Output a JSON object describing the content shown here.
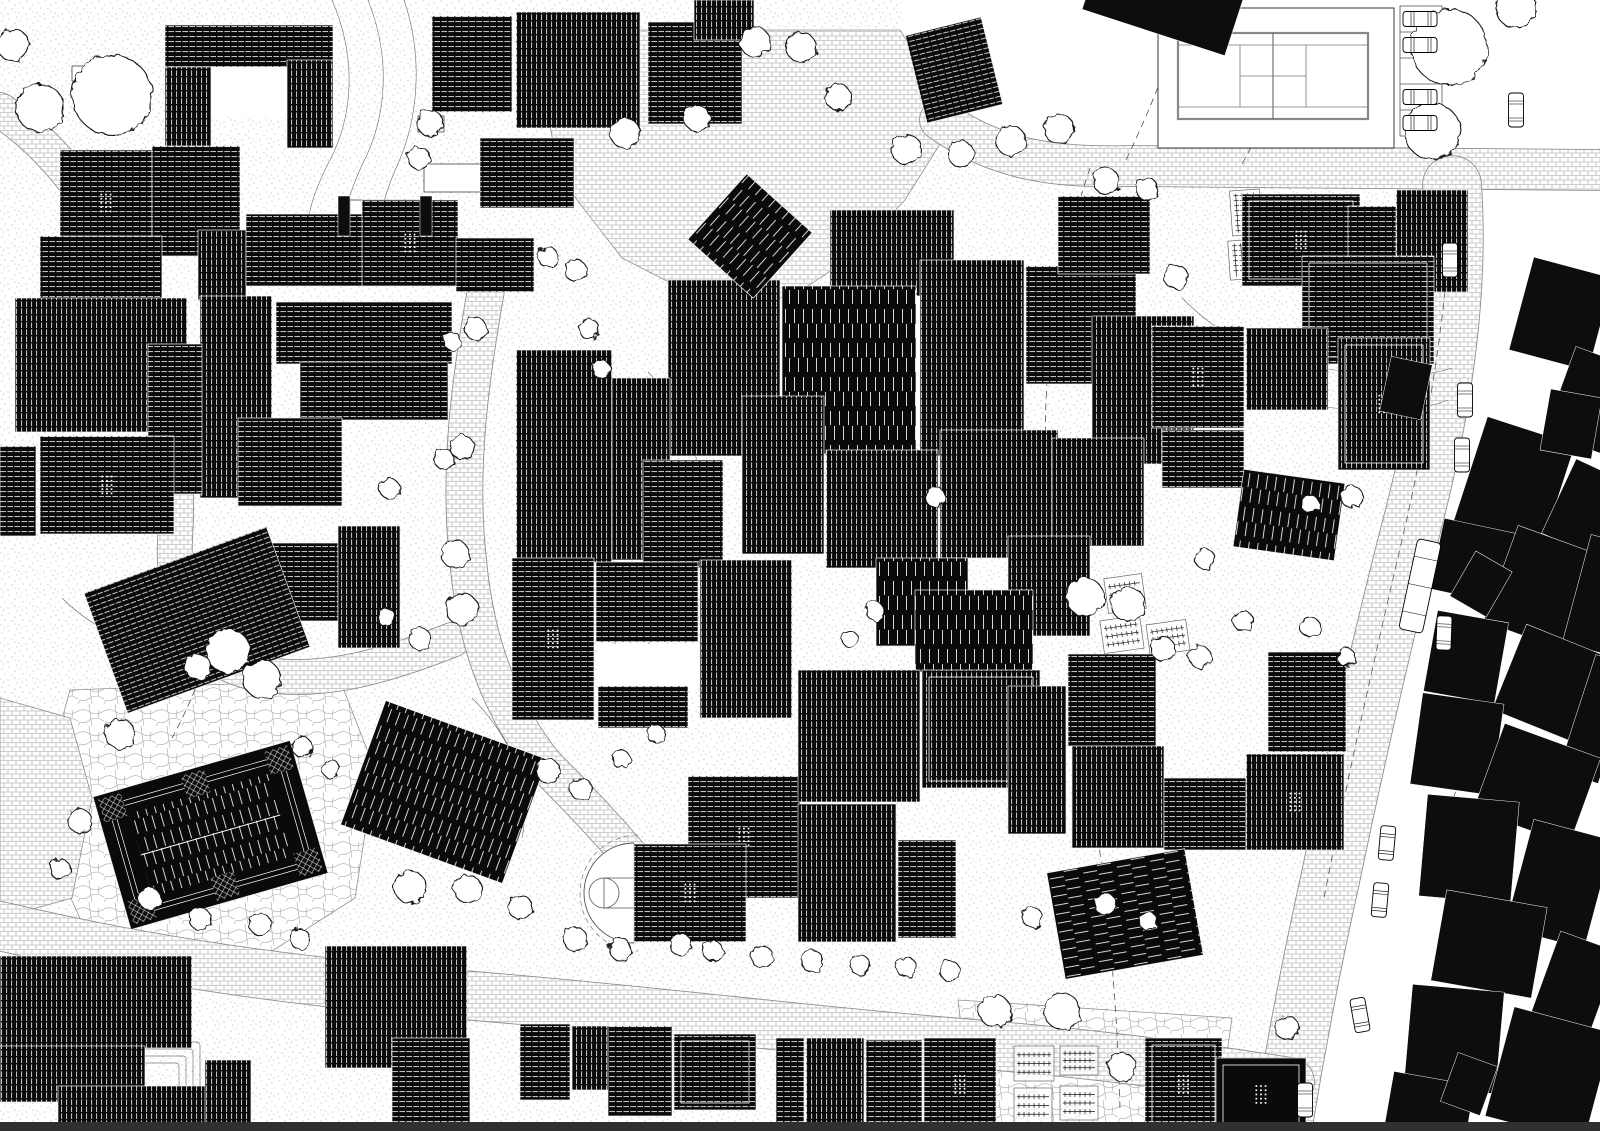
{
  "canvas": {
    "width": 1600,
    "height": 1131,
    "background": "#ffffff"
  },
  "palette": {
    "building_fill": "#0a0a0a",
    "context_fill": "#0d0d0d",
    "hatch_line": "#ececec",
    "road_edge": "#8f8f8f",
    "court_line": "#888888",
    "contour_line": "#6a6a6a",
    "dash_line": "#555555",
    "tree_stroke": "#141414",
    "bottom_strip": "#303030"
  },
  "legend": {
    "h": "horizontal-ridge-hatch-roof",
    "v": "vertical-ridge-hatch-roof",
    "vd": "standing-seam-vertical-roof",
    "hd": "standing-seam-horizontal-roof",
    "s": "solid-black-roof",
    "flag_d": "rooflight-dot-grid",
    "flag_i": "white-inset-parapet-line"
  },
  "zones_white": [
    "1125,0 1600,0 1600,148 1125,148",
    "1468,186 1600,186 1600,1131 1284,1131 1318,952 1362,762 1412,562 1452,362",
    "902,0 1128,0 1128,148 995,148 902,58"
  ],
  "plazas": [
    {
      "texture": "cobble",
      "points": "560,30 900,30 955,120 905,200 850,258 790,298 700,298 622,258 560,178 545,100"
    },
    {
      "texture": "flagstone",
      "points": "70,690 340,680 375,770 355,898 255,962 95,952 35,818"
    },
    {
      "texture": "cobble",
      "points": "0,698 70,718 92,798 72,898 0,918"
    },
    {
      "texture": "flagstone",
      "points": "958,1000 1232,1018 1216,1131 974,1131"
    }
  ],
  "roads": [
    {
      "d": "M940,120 C1000,162 1060,168 1130,166 L1600,170",
      "w": 40
    },
    {
      "d": "M1452,185 C1460,300 1440,420 1408,540 C1380,650 1355,760 1330,880 C1310,970 1295,1050 1282,1131",
      "w": 58
    },
    {
      "d": "M0,926 C150,962 300,982 450,994 C650,1010 800,1030 950,1042 C1050,1050 1150,1060 1290,1082",
      "w": 48
    },
    {
      "d": "M0,110 C60,150 110,220 140,300 C170,380 180,460 175,540 C172,620 195,662 260,674 C330,686 400,660 452,640",
      "w": 34
    },
    {
      "d": "M486,290 C470,380 458,470 468,560 C476,650 505,715 545,765 C580,800 608,830 630,856",
      "w": 36
    }
  ],
  "contour_lines": [
    "M332,0 C358,60 352,118 330,160 C310,198 302,228 312,258",
    "M368,0 C392,60 386,120 362,165 C344,205 338,232 348,262",
    "M404,0 C424,58 418,122 396,168 C380,206 374,236 382,262",
    "M622,382 C660,420 680,468 670,518 C660,568 640,608 612,648",
    "M648,372 C688,414 708,468 698,524 C690,570 672,612 644,650",
    "M942,438 C982,468 1002,498 992,538",
    "M1182,298 C1222,338 1262,358 1322,368 C1382,378 1422,378 1452,368",
    "M1174,336 C1216,376 1258,396 1318,406 C1378,414 1418,412 1448,400",
    "M62,598 C102,638 142,648 202,642",
    "M472,698 C512,738 532,788 522,838",
    "M22,1058 C62,1078 102,1088 162,1088"
  ],
  "dashed_lines": [
    "M1185,8 C1170,60 1150,110 1126,160",
    "M1300,12 C1290,66 1268,118 1242,164",
    "M1090,168 C1060,258 1042,358 1046,458",
    "M1452,195 C1448,300 1430,420 1402,540 C1374,660 1347,780 1324,898",
    "M1098,838 C1110,928 1118,1018 1120,1110",
    "M1502,618 C1482,698 1456,788 1432,878",
    "M232,538 C225,608 205,678 172,738"
  ],
  "terraces": [
    [
      940,
      445,
      90,
      55,
      4
    ],
    [
      60,
      1042,
      140,
      70,
      4
    ]
  ],
  "buildings": [
    [
      165,
      25,
      168,
      42,
      0,
      "h",
      ""
    ],
    [
      165,
      67,
      46,
      82,
      0,
      "v",
      ""
    ],
    [
      287,
      60,
      46,
      88,
      0,
      "v",
      ""
    ],
    [
      60,
      150,
      92,
      106,
      0,
      "h",
      "d"
    ],
    [
      152,
      146,
      88,
      110,
      0,
      "h",
      ""
    ],
    [
      40,
      236,
      122,
      66,
      0,
      "h",
      ""
    ],
    [
      198,
      230,
      48,
      70,
      0,
      "v",
      ""
    ],
    [
      246,
      214,
      118,
      72,
      0,
      "h",
      ""
    ],
    [
      362,
      200,
      96,
      86,
      0,
      "h",
      "d"
    ],
    [
      456,
      238,
      78,
      54,
      0,
      "h",
      ""
    ],
    [
      432,
      16,
      80,
      96,
      0,
      "h",
      ""
    ],
    [
      516,
      12,
      124,
      116,
      0,
      "v",
      ""
    ],
    [
      648,
      22,
      94,
      102,
      0,
      "h",
      ""
    ],
    [
      694,
      0,
      60,
      40,
      0,
      "v",
      ""
    ],
    [
      480,
      138,
      94,
      70,
      0,
      "h",
      ""
    ],
    [
      915,
      25,
      78,
      90,
      -14,
      "h",
      ""
    ],
    [
      15,
      298,
      172,
      134,
      0,
      "v",
      ""
    ],
    [
      200,
      296,
      72,
      202,
      0,
      "v",
      ""
    ],
    [
      276,
      302,
      176,
      62,
      0,
      "h",
      ""
    ],
    [
      300,
      362,
      148,
      58,
      0,
      "h",
      ""
    ],
    [
      148,
      344,
      54,
      150,
      0,
      "h",
      ""
    ],
    [
      40,
      436,
      134,
      98,
      0,
      "h",
      "d"
    ],
    [
      238,
      418,
      104,
      88,
      0,
      "h",
      ""
    ],
    [
      240,
      543,
      98,
      78,
      0,
      "h",
      ""
    ],
    [
      338,
      526,
      62,
      122,
      0,
      "v",
      ""
    ],
    [
      100,
      556,
      194,
      128,
      -20,
      "h",
      ""
    ],
    [
      0,
      446,
      36,
      90,
      0,
      "h",
      ""
    ],
    [
      830,
      210,
      124,
      86,
      0,
      "v",
      ""
    ],
    [
      668,
      280,
      112,
      176,
      0,
      "v",
      ""
    ],
    [
      782,
      286,
      134,
      168,
      0,
      "vd",
      ""
    ],
    [
      920,
      260,
      104,
      196,
      0,
      "v",
      ""
    ],
    [
      1026,
      266,
      110,
      118,
      0,
      "h",
      ""
    ],
    [
      1058,
      196,
      92,
      78,
      0,
      "h",
      ""
    ],
    [
      1092,
      316,
      102,
      148,
      0,
      "v",
      ""
    ],
    [
      742,
      396,
      82,
      158,
      0,
      "v",
      ""
    ],
    [
      826,
      450,
      112,
      118,
      0,
      "v",
      ""
    ],
    [
      940,
      430,
      118,
      128,
      0,
      "v",
      ""
    ],
    [
      1052,
      438,
      92,
      108,
      0,
      "v",
      ""
    ],
    [
      876,
      558,
      92,
      88,
      0,
      "vd",
      ""
    ],
    [
      1008,
      536,
      82,
      100,
      0,
      "v",
      ""
    ],
    [
      915,
      590,
      118,
      82,
      0,
      "vd",
      ""
    ],
    [
      516,
      350,
      96,
      212,
      0,
      "v",
      ""
    ],
    [
      612,
      378,
      58,
      182,
      0,
      "v",
      ""
    ],
    [
      643,
      460,
      80,
      108,
      0,
      "h",
      ""
    ],
    [
      706,
      192,
      88,
      88,
      42,
      "vd",
      ""
    ],
    [
      512,
      558,
      82,
      162,
      0,
      "h",
      "d"
    ],
    [
      596,
      562,
      102,
      80,
      0,
      "h",
      ""
    ],
    [
      700,
      560,
      92,
      158,
      0,
      "v",
      ""
    ],
    [
      598,
      686,
      90,
      42,
      0,
      "h",
      ""
    ],
    [
      688,
      776,
      112,
      122,
      0,
      "h",
      "d"
    ],
    [
      798,
      670,
      122,
      132,
      0,
      "v",
      ""
    ],
    [
      922,
      670,
      118,
      118,
      0,
      "v",
      "i"
    ],
    [
      1008,
      686,
      58,
      148,
      0,
      "v",
      ""
    ],
    [
      798,
      804,
      98,
      138,
      0,
      "v",
      ""
    ],
    [
      898,
      840,
      58,
      98,
      0,
      "h",
      ""
    ],
    [
      634,
      844,
      112,
      98,
      0,
      "h",
      "d"
    ],
    [
      1068,
      654,
      88,
      92,
      0,
      "h",
      ""
    ],
    [
      1072,
      746,
      92,
      102,
      0,
      "v",
      ""
    ],
    [
      1164,
      778,
      82,
      72,
      0,
      "h",
      ""
    ],
    [
      1246,
      754,
      98,
      96,
      0,
      "v",
      "d"
    ],
    [
      1268,
      652,
      78,
      100,
      0,
      "h",
      ""
    ],
    [
      1055,
      860,
      140,
      108,
      -10,
      "hd",
      ""
    ],
    [
      1242,
      194,
      118,
      92,
      0,
      "h",
      "di"
    ],
    [
      1348,
      206,
      78,
      82,
      0,
      "h",
      ""
    ],
    [
      1396,
      190,
      72,
      102,
      0,
      "v",
      ""
    ],
    [
      1302,
      256,
      132,
      108,
      0,
      "h",
      "i"
    ],
    [
      1152,
      326,
      92,
      102,
      0,
      "h",
      "d"
    ],
    [
      1246,
      328,
      82,
      82,
      0,
      "v",
      ""
    ],
    [
      1338,
      338,
      92,
      132,
      0,
      "v",
      "di"
    ],
    [
      1162,
      430,
      82,
      58,
      0,
      "h",
      ""
    ],
    [
      1238,
      476,
      102,
      78,
      8,
      "vd",
      ""
    ],
    [
      358,
      726,
      172,
      132,
      20,
      "vd",
      ""
    ],
    [
      0,
      956,
      192,
      92,
      0,
      "v",
      ""
    ],
    [
      0,
      1046,
      145,
      56,
      0,
      "v",
      ""
    ],
    [
      58,
      1086,
      190,
      45,
      0,
      "v",
      ""
    ],
    [
      205,
      1060,
      46,
      71,
      0,
      "v",
      ""
    ],
    [
      325,
      946,
      142,
      122,
      0,
      "v",
      ""
    ],
    [
      392,
      1038,
      78,
      93,
      0,
      "h",
      ""
    ],
    [
      520,
      1024,
      50,
      76,
      0,
      "h",
      ""
    ],
    [
      572,
      1026,
      40,
      64,
      0,
      "v",
      ""
    ],
    [
      608,
      1026,
      64,
      90,
      0,
      "h",
      ""
    ],
    [
      674,
      1034,
      82,
      76,
      0,
      "h",
      "i"
    ],
    [
      776,
      1038,
      28,
      93,
      0,
      "h",
      ""
    ],
    [
      806,
      1038,
      58,
      93,
      0,
      "v",
      ""
    ],
    [
      866,
      1040,
      56,
      91,
      0,
      "h",
      ""
    ],
    [
      924,
      1038,
      72,
      93,
      0,
      "h",
      "d"
    ],
    [
      1145,
      1038,
      77,
      93,
      0,
      "h",
      "di"
    ],
    [
      1216,
      1058,
      90,
      73,
      0,
      "s",
      "di"
    ]
  ],
  "special_building": {
    "x": 108,
    "y": 766,
    "w": 205,
    "h": 138,
    "rot": -16
  },
  "context_buildings": [
    [
      1088,
      -28,
      150,
      62,
      18
    ],
    [
      338,
      196,
      12,
      40,
      0
    ],
    [
      420,
      196,
      12,
      40,
      0
    ],
    [
      1520,
      266,
      82,
      96,
      15
    ],
    [
      1558,
      356,
      72,
      92,
      20
    ],
    [
      1468,
      428,
      92,
      112,
      18
    ],
    [
      1556,
      468,
      62,
      82,
      25
    ],
    [
      1436,
      526,
      82,
      72,
      12
    ],
    [
      1498,
      538,
      92,
      102,
      20
    ],
    [
      1576,
      538,
      42,
      112,
      15
    ],
    [
      1430,
      616,
      72,
      82,
      10
    ],
    [
      1506,
      638,
      92,
      92,
      22
    ],
    [
      1576,
      658,
      42,
      122,
      18
    ],
    [
      1416,
      698,
      82,
      92,
      8
    ],
    [
      1486,
      738,
      102,
      92,
      20
    ],
    [
      1423,
      798,
      92,
      102,
      5
    ],
    [
      1518,
      828,
      82,
      112,
      15
    ],
    [
      1438,
      898,
      102,
      92,
      10
    ],
    [
      1538,
      938,
      62,
      122,
      20
    ],
    [
      1408,
      988,
      92,
      102,
      5
    ],
    [
      1498,
      1018,
      102,
      113,
      15
    ],
    [
      1388,
      1078,
      82,
      62,
      10
    ],
    [
      1545,
      393,
      52,
      62,
      10
    ],
    [
      1460,
      558,
      42,
      52,
      30
    ],
    [
      1448,
      1058,
      42,
      52,
      20
    ],
    [
      1385,
      360,
      42,
      56,
      12
    ]
  ],
  "white_rects": [
    [
      200,
      57,
      90,
      60
    ],
    [
      888,
      296,
      34,
      136
    ],
    [
      1322,
      282,
      76,
      56
    ],
    [
      598,
      644,
      102,
      44
    ]
  ],
  "misc_platforms": [
    [
      72,
      66,
      26,
      15
    ],
    [
      418,
      116,
      26,
      16
    ],
    [
      424,
      164,
      58,
      28
    ],
    [
      350,
      200,
      72,
      32
    ],
    [
      700,
      420,
      16,
      24
    ]
  ],
  "tennis_court": {
    "outer": [
      1158,
      8,
      236,
      140
    ],
    "court": [
      1178,
      33,
      190,
      86
    ]
  },
  "parking": {
    "lot": [
      1400,
      6,
      42,
      130
    ],
    "stalls": 5
  },
  "basketball_court": {
    "cx": 634,
    "cy": 893,
    "r": 50,
    "key_half": 15,
    "circle_r": 15,
    "dash_r": 58
  },
  "garden_plots": [
    [
      1014,
      1046,
      40,
      35,
      0,
      3,
      "h"
    ],
    [
      1060,
      1046,
      38,
      29,
      0,
      3,
      "h"
    ],
    [
      1014,
      1088,
      38,
      35,
      0,
      3,
      "h"
    ],
    [
      1060,
      1086,
      38,
      34,
      0,
      3,
      "h"
    ],
    [
      1106,
      576,
      38,
      35,
      -8,
      3,
      "h"
    ],
    [
      1102,
      618,
      40,
      33,
      -8,
      3,
      "h"
    ],
    [
      1148,
      622,
      40,
      31,
      -8,
      3,
      "h"
    ],
    [
      1231,
      190,
      30,
      45,
      -4,
      4,
      "v"
    ],
    [
      1229,
      240,
      32,
      39,
      -4,
      4,
      "v"
    ]
  ],
  "trees": [
    [
      112,
      95,
      40
    ],
    [
      40,
      108,
      24
    ],
    [
      13,
      45,
      16
    ],
    [
      430,
      123,
      13
    ],
    [
      419,
      158,
      11
    ],
    [
      625,
      133,
      15
    ],
    [
      697,
      118,
      13
    ],
    [
      755,
      42,
      15
    ],
    [
      801,
      47,
      15
    ],
    [
      838,
      97,
      13
    ],
    [
      906,
      149,
      15
    ],
    [
      961,
      154,
      13
    ],
    [
      1011,
      141,
      15
    ],
    [
      1059,
      129,
      15
    ],
    [
      1106,
      181,
      13
    ],
    [
      1147,
      189,
      11
    ],
    [
      1176,
      277,
      12
    ],
    [
      1449,
      47,
      38
    ],
    [
      1432,
      131,
      28
    ],
    [
      1516,
      8,
      20
    ],
    [
      548,
      257,
      10
    ],
    [
      576,
      271,
      11
    ],
    [
      589,
      329,
      10
    ],
    [
      601,
      369,
      9
    ],
    [
      476,
      329,
      11
    ],
    [
      452,
      341,
      9
    ],
    [
      462,
      447,
      12
    ],
    [
      444,
      459,
      10
    ],
    [
      390,
      489,
      10
    ],
    [
      455,
      554,
      14
    ],
    [
      462,
      609,
      16
    ],
    [
      420,
      639,
      11
    ],
    [
      386,
      617,
      9
    ],
    [
      228,
      651,
      22
    ],
    [
      262,
      679,
      19
    ],
    [
      198,
      667,
      13
    ],
    [
      120,
      734,
      15
    ],
    [
      80,
      821,
      12
    ],
    [
      60,
      869,
      10
    ],
    [
      302,
      747,
      10
    ],
    [
      331,
      769,
      9
    ],
    [
      548,
      771,
      12
    ],
    [
      581,
      789,
      11
    ],
    [
      621,
      759,
      9
    ],
    [
      656,
      734,
      9
    ],
    [
      410,
      887,
      16
    ],
    [
      468,
      889,
      14
    ],
    [
      520,
      907,
      12
    ],
    [
      575,
      939,
      12
    ],
    [
      620,
      949,
      11
    ],
    [
      680,
      944,
      11
    ],
    [
      713,
      951,
      10
    ],
    [
      762,
      957,
      11
    ],
    [
      812,
      961,
      11
    ],
    [
      860,
      965,
      10
    ],
    [
      906,
      967,
      10
    ],
    [
      950,
      971,
      10
    ],
    [
      260,
      924,
      11
    ],
    [
      300,
      939,
      10
    ],
    [
      200,
      919,
      11
    ],
    [
      150,
      899,
      11
    ],
    [
      995,
      1011,
      16
    ],
    [
      1062,
      1011,
      18
    ],
    [
      1122,
      1067,
      14
    ],
    [
      1085,
      597,
      19
    ],
    [
      1128,
      604,
      17
    ],
    [
      1163,
      649,
      12
    ],
    [
      1200,
      657,
      11
    ],
    [
      1243,
      621,
      10
    ],
    [
      1310,
      627,
      10
    ],
    [
      1346,
      657,
      9
    ],
    [
      935,
      497,
      10
    ],
    [
      1205,
      559,
      10
    ],
    [
      1352,
      497,
      11
    ],
    [
      1310,
      504,
      9
    ],
    [
      1105,
      904,
      11
    ],
    [
      1148,
      921,
      9
    ],
    [
      1032,
      917,
      10
    ],
    [
      875,
      611,
      9
    ],
    [
      850,
      639,
      8
    ],
    [
      1287,
      1028,
      12
    ]
  ],
  "cars": [
    [
      1420,
      19,
      0
    ],
    [
      1420,
      45,
      0
    ],
    [
      1420,
      97,
      0
    ],
    [
      1420,
      123,
      0
    ],
    [
      1516,
      110,
      90
    ],
    [
      1450,
      260,
      90
    ],
    [
      1465,
      400,
      90
    ],
    [
      1462,
      455,
      90
    ],
    [
      1444,
      633,
      92
    ],
    [
      1387,
      843,
      95
    ],
    [
      1380,
      900,
      95
    ],
    [
      1360,
      1015,
      80
    ],
    [
      1305,
      1100,
      90
    ]
  ],
  "vehicles": [
    [
      1420,
      586,
      24,
      92,
      12
    ]
  ],
  "bottom_strip": [
    0,
    1122,
    1600,
    9
  ]
}
